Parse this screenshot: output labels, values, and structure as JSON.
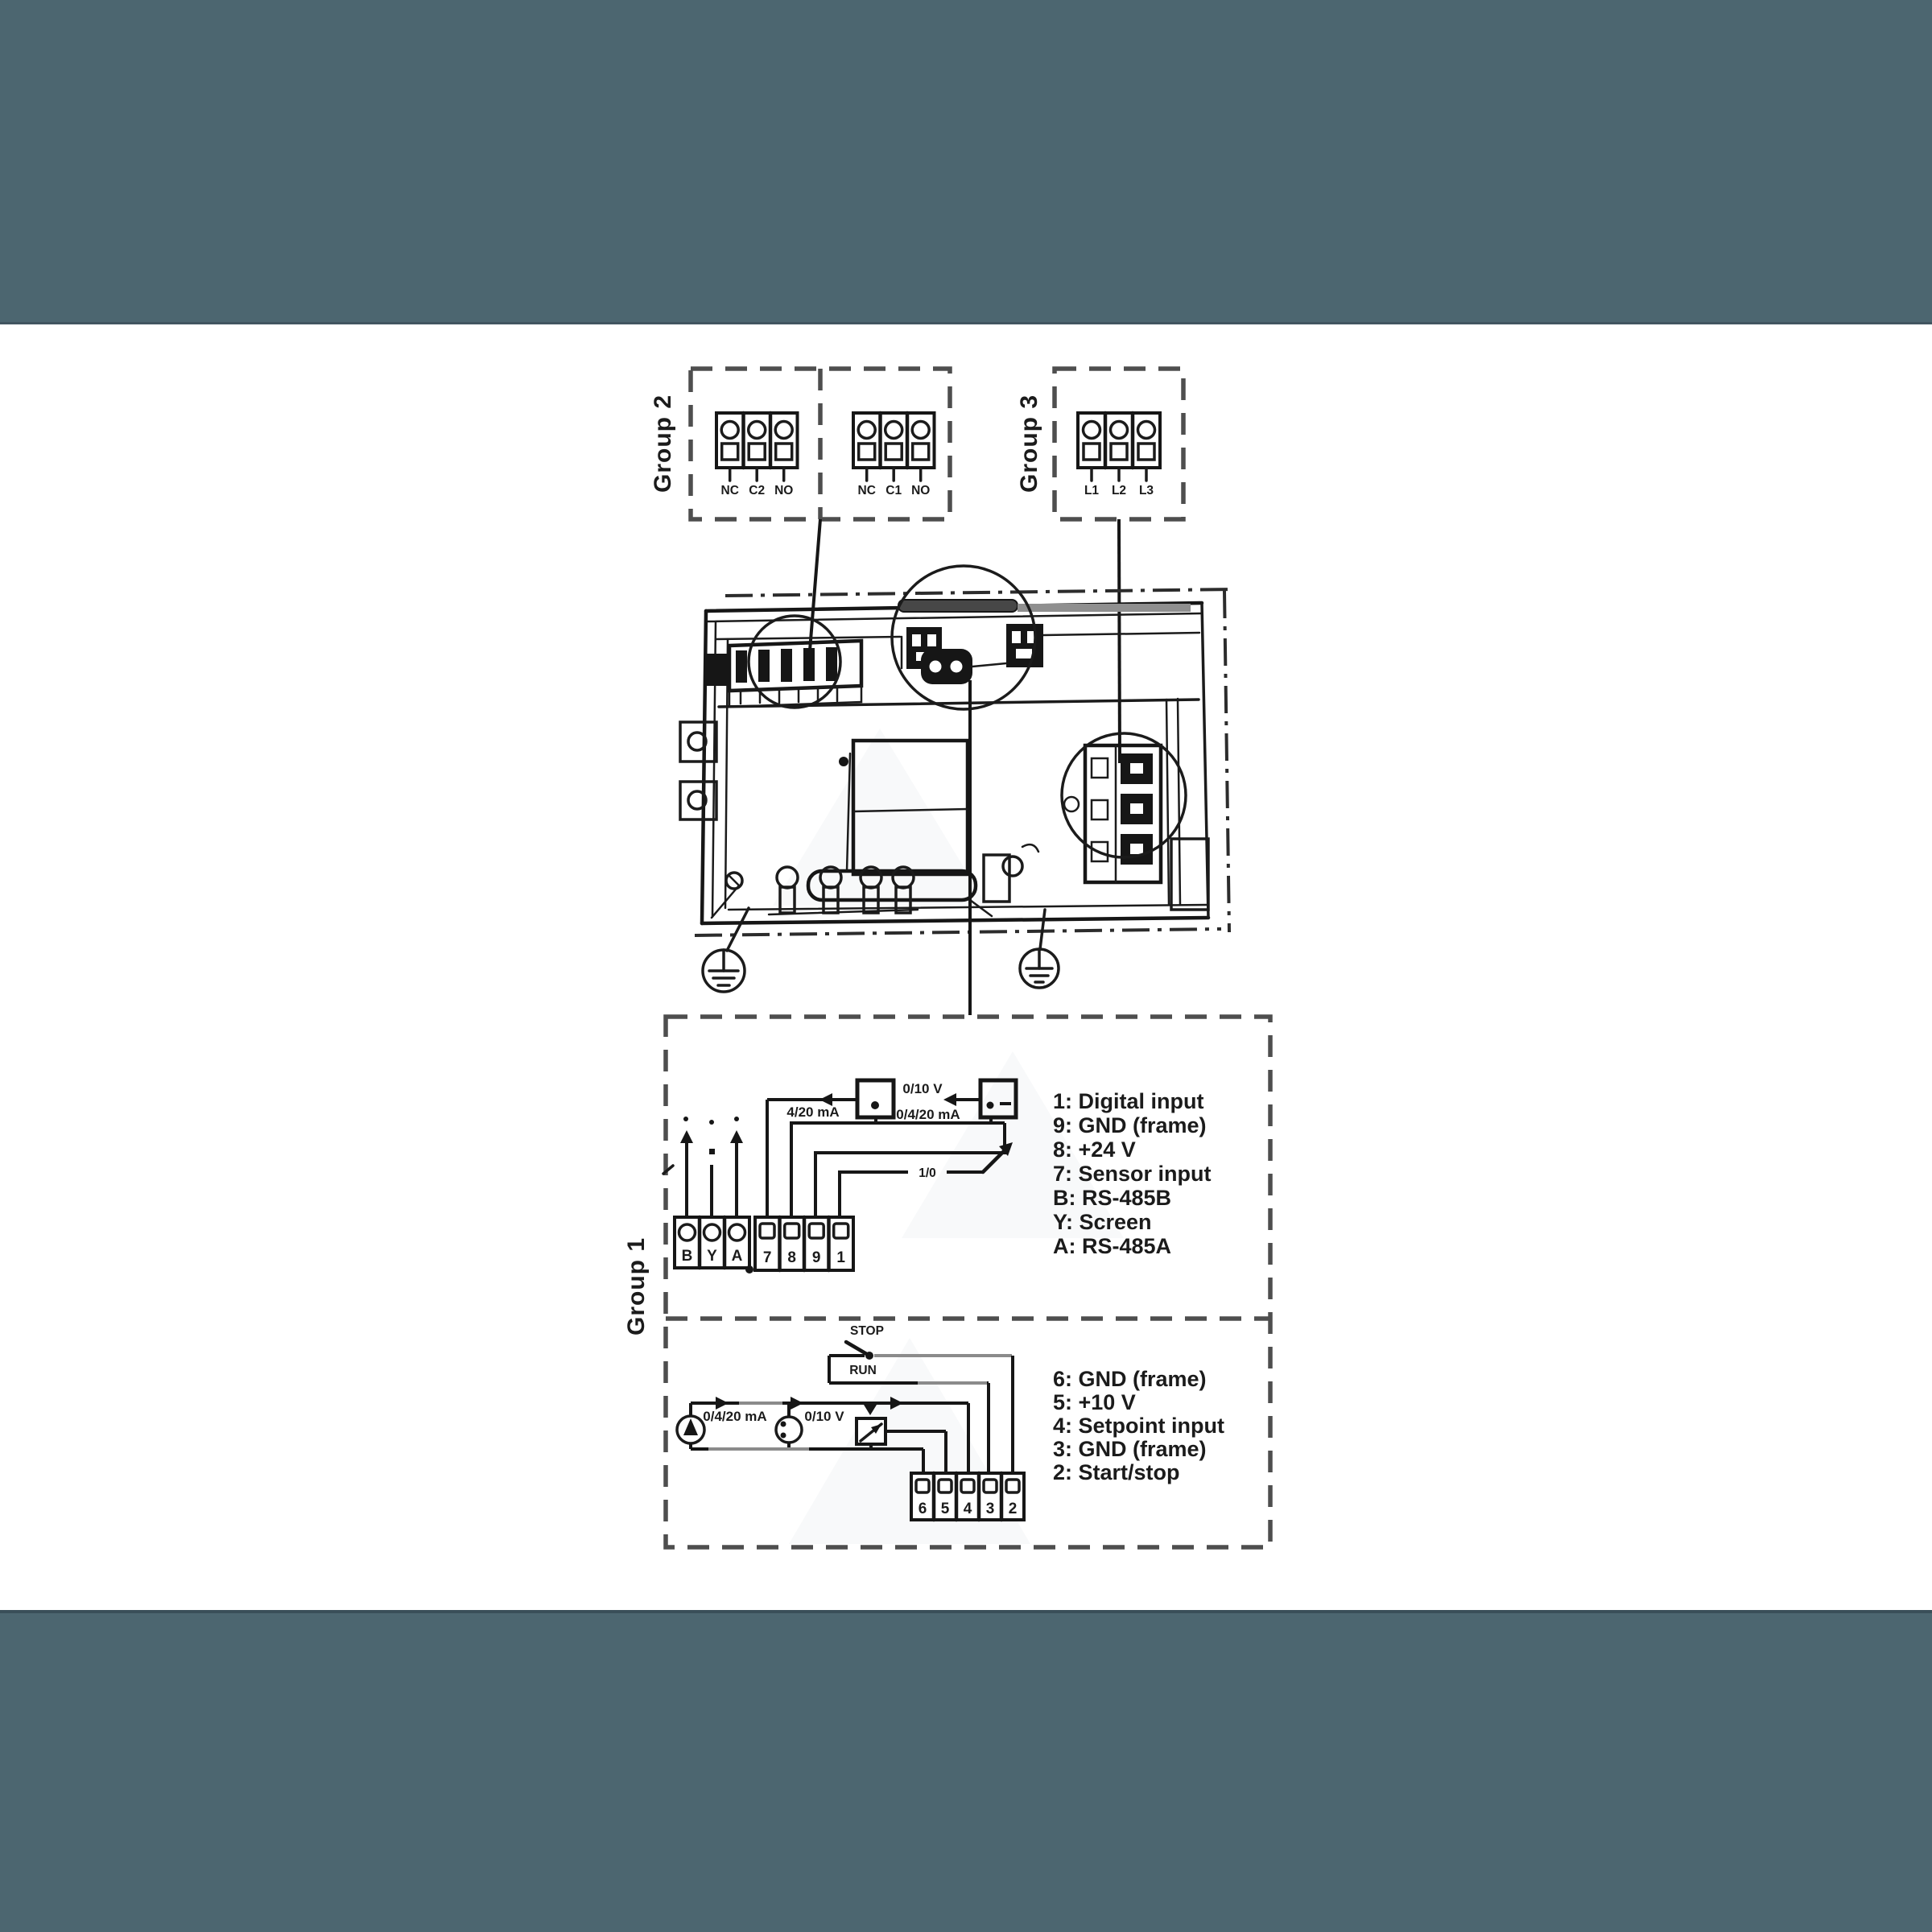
{
  "colors": {
    "band_teal": "#4c6670",
    "ink": "#1b1b1b",
    "dash_gray": "#4e4e4e",
    "wire_gray": "#8b8b8b",
    "background": "#ffffff"
  },
  "group2": {
    "label": "Group 2",
    "relay_left": [
      "NC",
      "C2",
      "NO"
    ],
    "relay_right": [
      "NC",
      "C1",
      "NO"
    ]
  },
  "group3": {
    "label": "Group 3",
    "mains": [
      "L1",
      "L2",
      "L3"
    ]
  },
  "group1": {
    "label": "Group 1",
    "upper": {
      "labels": {
        "v010": "0/10 V",
        "ma_0420": "0/4/20 mA",
        "ma_420": "4/20 mA",
        "switch": "1/0"
      },
      "comm_terminals": [
        "B",
        "Y",
        "A"
      ],
      "io_terminals": [
        "7",
        "8",
        "9",
        "1"
      ],
      "legend": [
        "1: Digital input",
        "9: GND (frame)",
        "8: +24 V",
        "7: Sensor input",
        "B: RS-485B",
        "Y: Screen",
        "A: RS-485A"
      ]
    },
    "lower": {
      "labels": {
        "stop": "STOP",
        "run": "RUN",
        "ma_0420": "0/4/20 mA",
        "v010": "0/10 V"
      },
      "terminals": [
        "6",
        "5",
        "4",
        "3",
        "2"
      ],
      "legend": [
        "6: GND (frame)",
        "5: +10 V",
        "4: Setpoint input",
        "3: GND (frame)",
        "2: Start/stop"
      ]
    }
  }
}
